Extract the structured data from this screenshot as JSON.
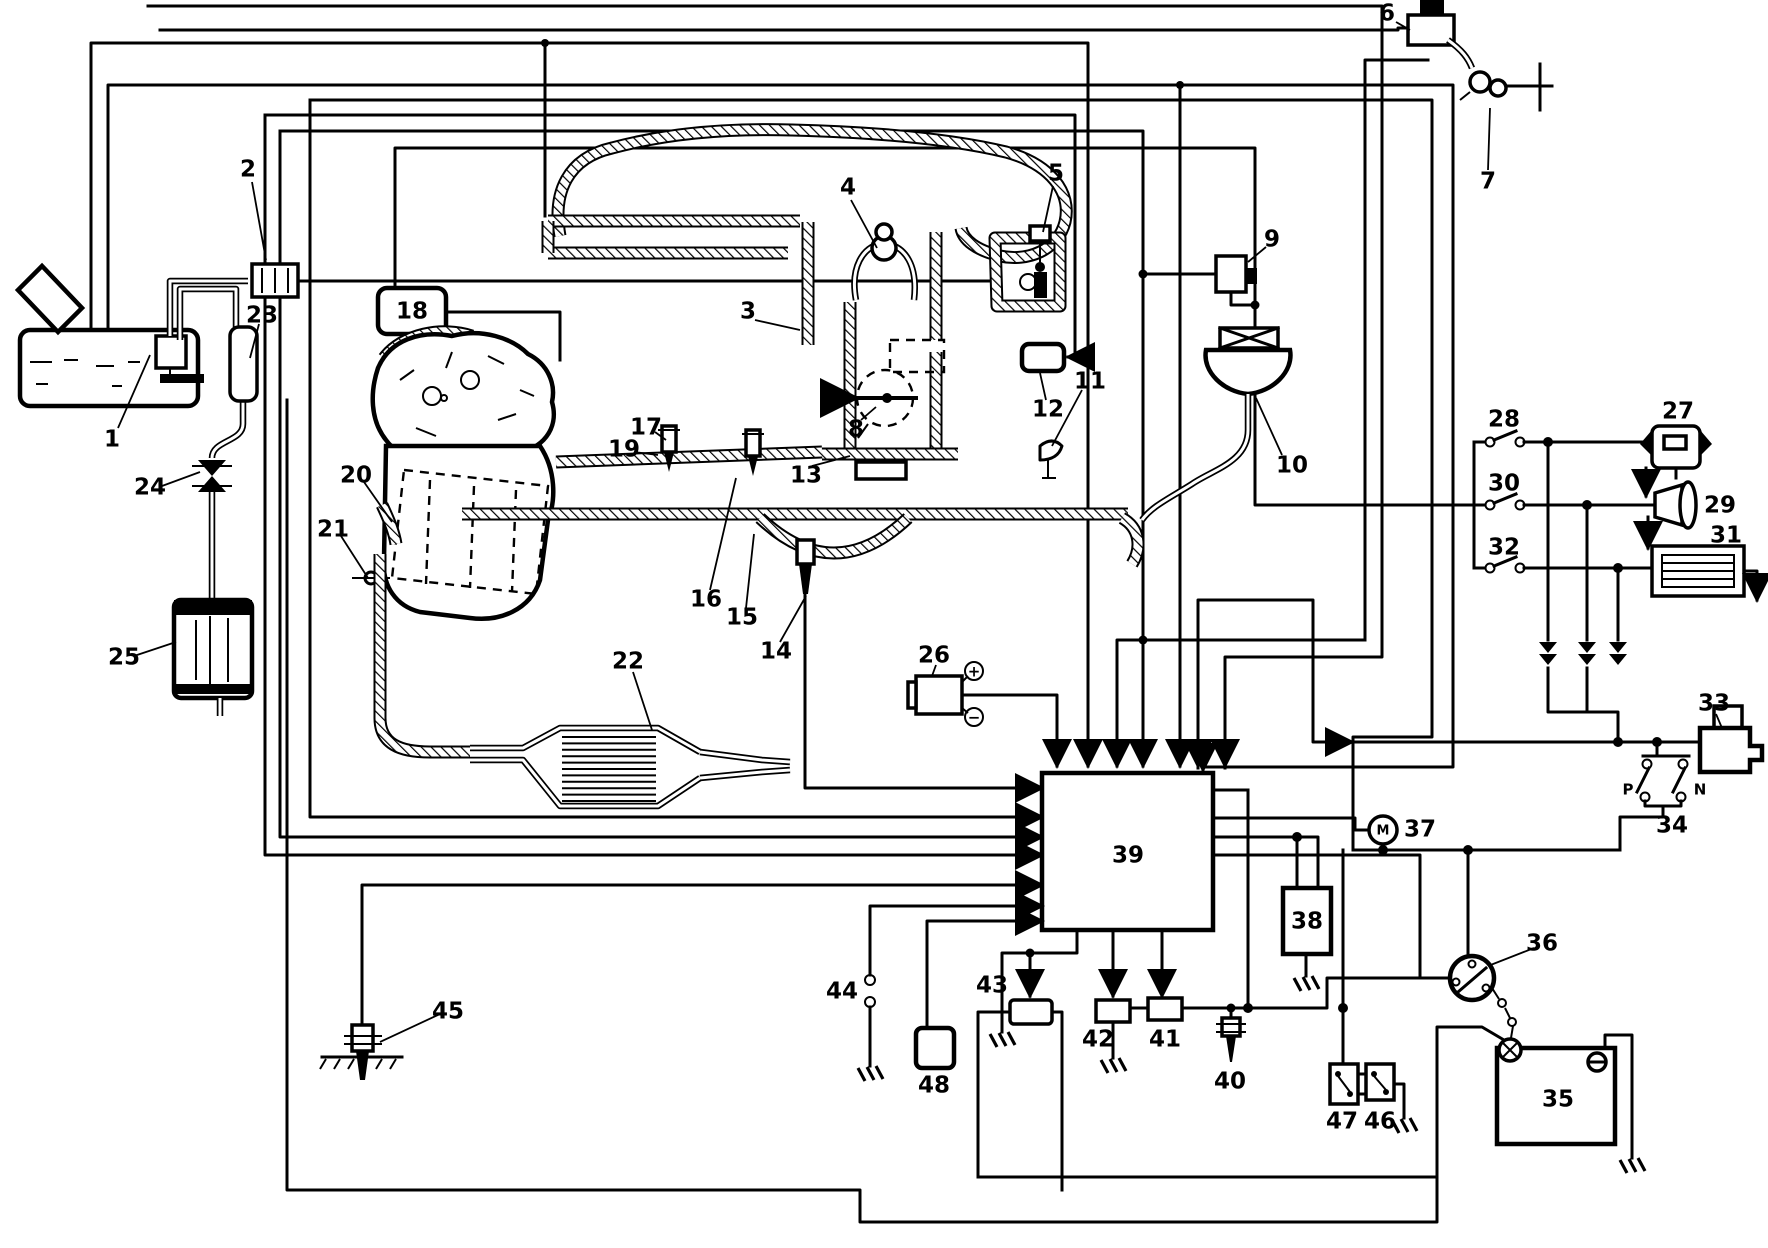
{
  "colors": {
    "ink": "#000000",
    "paper": "#ffffff"
  },
  "labels": {
    "n1": "1",
    "n2": "2",
    "n3": "3",
    "n4": "4",
    "n5": "5",
    "n6": "6",
    "n7": "7",
    "n8": "8",
    "n9": "9",
    "n10": "10",
    "n11": "11",
    "n12": "12",
    "n13": "13",
    "n14": "14",
    "n15": "15",
    "n16": "16",
    "n17": "17",
    "n18": "18",
    "n19": "19",
    "n20": "20",
    "n21": "21",
    "n22": "22",
    "n23": "23",
    "n24": "24",
    "n25": "25",
    "n26": "26",
    "n27": "27",
    "n28": "28",
    "n29": "29",
    "n30": "30",
    "n31": "31",
    "n32": "32",
    "n33": "33",
    "n34": "34",
    "n35": "35",
    "n36": "36",
    "n37": "37",
    "n38": "38",
    "n39": "39",
    "n40": "40",
    "n41": "41",
    "n42": "42",
    "n43": "43",
    "n44": "44",
    "n45": "45",
    "n46": "46",
    "n47": "47",
    "n48": "48"
  },
  "letters": {
    "park": "P",
    "neutral": "N",
    "motor": "M"
  },
  "coil": {
    "plus": "+",
    "minus": "−"
  }
}
